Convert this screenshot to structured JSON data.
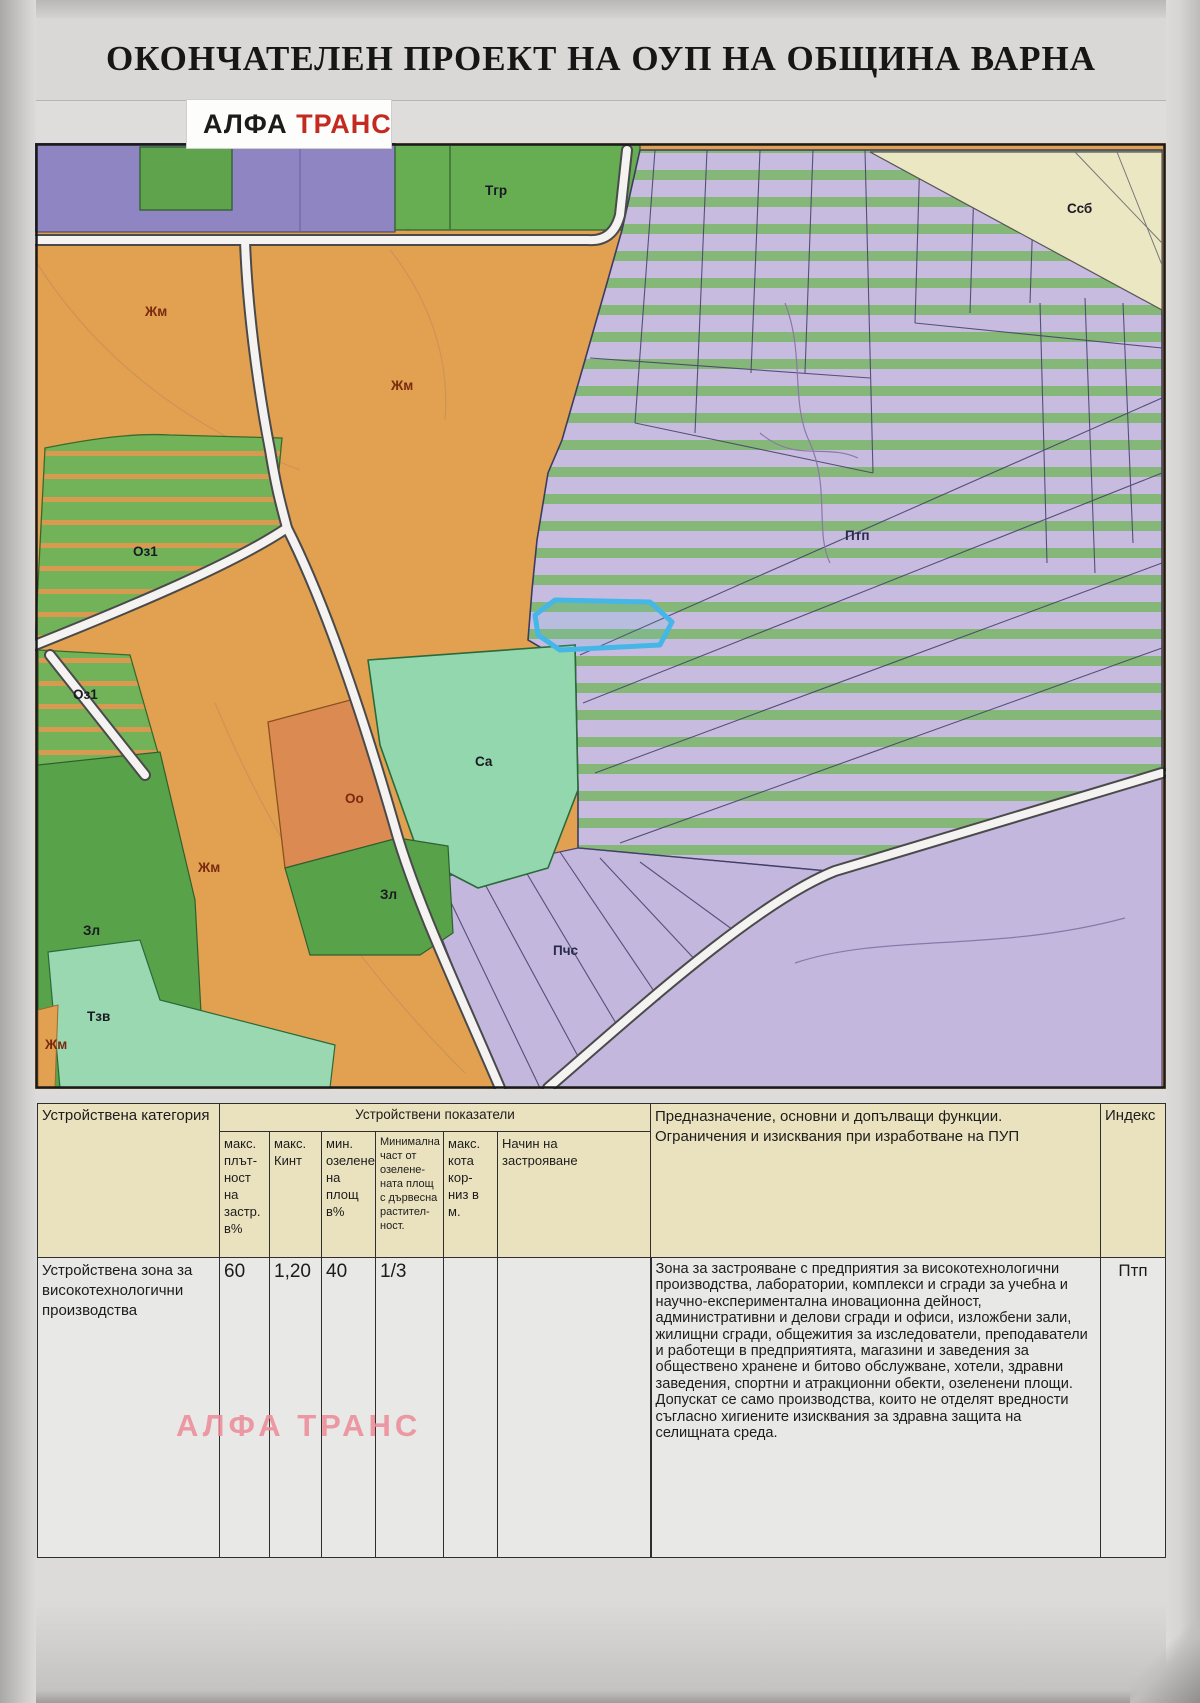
{
  "title": "ОКОНЧАТЕЛЕН ПРОЕКТ НА ОУП НА ОБЩИНА ВАРНА",
  "logo": {
    "black": "АЛФА",
    "red": "ТРАНС"
  },
  "watermark": "АЛФА ТРАНС",
  "map": {
    "labels": [
      {
        "text": "Тгр",
        "x": 450,
        "y": 52,
        "c": "dark"
      },
      {
        "text": "Ссб",
        "x": 1032,
        "y": 70,
        "c": "dark"
      },
      {
        "text": "Жм",
        "x": 110,
        "y": 173,
        "c": "red"
      },
      {
        "text": "Жм",
        "x": 356,
        "y": 247,
        "c": "red"
      },
      {
        "text": "Оз1",
        "x": 98,
        "y": 413,
        "c": "dark"
      },
      {
        "text": "Оз1",
        "x": 38,
        "y": 556,
        "c": "dark"
      },
      {
        "text": "Птп",
        "x": 810,
        "y": 397,
        "c": "navy"
      },
      {
        "text": "Са",
        "x": 440,
        "y": 623,
        "c": "dark"
      },
      {
        "text": "Оо",
        "x": 310,
        "y": 660,
        "c": "red"
      },
      {
        "text": "Жм",
        "x": 163,
        "y": 729,
        "c": "red"
      },
      {
        "text": "Зл",
        "x": 345,
        "y": 756,
        "c": "dark"
      },
      {
        "text": "Зл",
        "x": 48,
        "y": 792,
        "c": "dark"
      },
      {
        "text": "Тзв",
        "x": 52,
        "y": 878,
        "c": "dark"
      },
      {
        "text": "Жм",
        "x": 10,
        "y": 906,
        "c": "red"
      },
      {
        "text": "Пчс",
        "x": 518,
        "y": 812,
        "c": "navy"
      }
    ]
  },
  "table": {
    "category_header": "Устройствена категория",
    "group_header": "Устройствени показатели",
    "sub_headers": [
      "макс.\nплът-\nност\nна\nзастр.\nв%",
      "макс.\nКинт",
      "мин.\nозелене\nна площ\nв%",
      "Минимална\nчаст от\nозелене-\nната площ\nс дървесна\nрастител-\nност.",
      "макс.\nкота\nкор-\nниз в\nм.",
      "Начин на\nзастрояване"
    ],
    "purpose_header": "Предназначение, основни и допълващи функции.\nОграничения и изисквания при изработване на ПУП",
    "index_header": "Индекс",
    "row": {
      "category": "Устройствена зона за\nвисокотехнологични\nпроизводства",
      "max_density": "60",
      "max_kint": "1,20",
      "min_green": "40",
      "min_tree_part": "1/3",
      "max_height": "",
      "building_mode": "",
      "purpose": "Зона за застрояване с предприятия за високотехнологични производства, лаборатории, комплекси и сгради за учебна и научно-експериментална иновационна дейност, административни и делови сгради и офиси, изложбени зали, жилищни сгради, общежития за изследователи, преподаватели и работещи в предприятията, магазини и заведения за обществено хранене и битово обслужване, хотели, здравни заведения, спортни и атракционни обекти, озеленени площи.\nДопускат се само производства, които не отделят вредности съгласно хигиените изисквания за здравна защита на селищната среда.",
      "index": "Птп"
    }
  },
  "colors": {
    "residential_orange": "#e2a150",
    "hightech_purple": "#c7bcdf",
    "stripe_green": "#85b878",
    "top_purple": "#8f85c2",
    "park_green": "#67ad52",
    "sport_mint": "#92d7ad",
    "cream_ssb": "#ece7c3",
    "public_salmon": "#db8b52",
    "road_fill": "#f4f3f1",
    "highlight_blue": "#45b6e8",
    "header_cream": "#eae2bf",
    "logo_red": "#c32a20",
    "watermark_pink": "#ec8996"
  }
}
